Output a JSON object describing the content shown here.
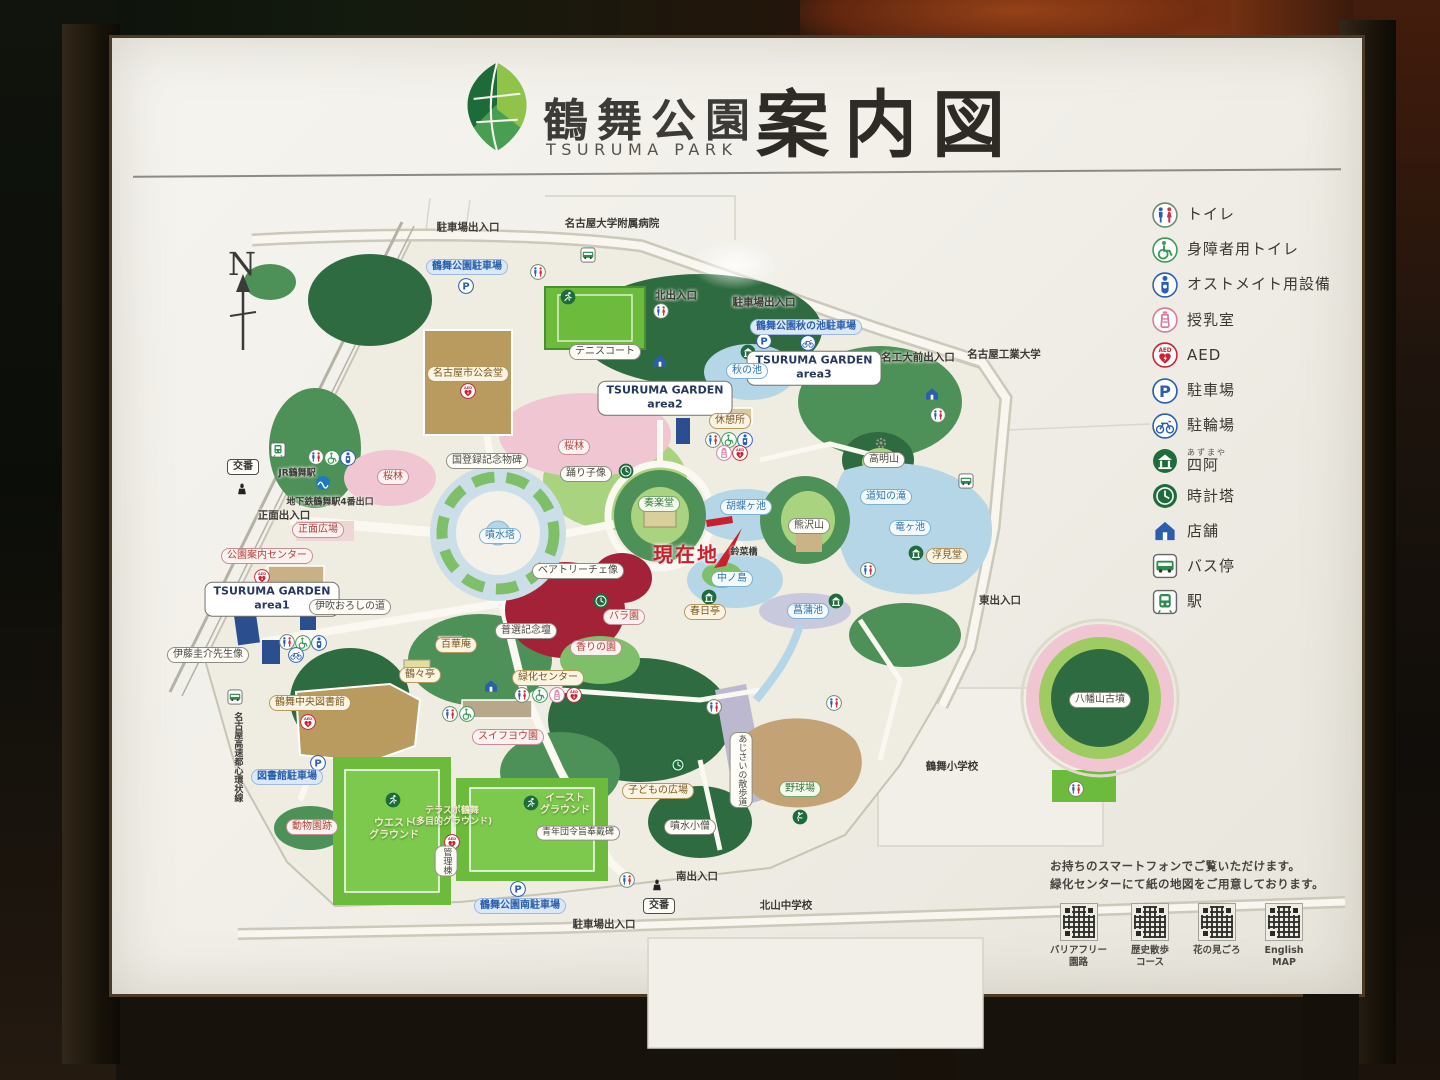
{
  "header": {
    "jp": "鶴舞公園",
    "en": "TSURUMA PARK",
    "main": "案内図"
  },
  "legend": {
    "items": [
      {
        "icon": "toilet",
        "label": "トイレ"
      },
      {
        "icon": "wheelchair",
        "label": "身障者用トイレ"
      },
      {
        "icon": "ostomate",
        "label": "オストメイト用設備"
      },
      {
        "icon": "nursing",
        "label": "授乳室"
      },
      {
        "icon": "aed",
        "label": "AED"
      },
      {
        "icon": "parking",
        "label": "駐車場"
      },
      {
        "icon": "bicycle",
        "label": "駐輪場"
      },
      {
        "icon": "azumaya",
        "label": "四阿",
        "ruby": "あずまや"
      },
      {
        "icon": "clock",
        "label": "時計塔"
      },
      {
        "icon": "shop",
        "label": "店舗"
      },
      {
        "icon": "bus",
        "label": "バス停"
      },
      {
        "icon": "station",
        "label": "駅"
      }
    ]
  },
  "map": {
    "north": "N",
    "current": {
      "t": "現在地",
      "x": 686,
      "y": 553
    },
    "labels": [
      {
        "t": "駐車場出入口",
        "x": 468,
        "y": 228,
        "s": "plain"
      },
      {
        "t": "名古屋大学附属病院",
        "x": 612,
        "y": 224,
        "s": "plain"
      },
      {
        "t": "北出入口",
        "x": 676,
        "y": 296,
        "s": "plain"
      },
      {
        "t": "駐車場出入口",
        "x": 764,
        "y": 303,
        "s": "plain"
      },
      {
        "t": "名工大前出入口",
        "x": 918,
        "y": 358,
        "s": "plain"
      },
      {
        "t": "名古屋工業大学",
        "x": 1004,
        "y": 355,
        "s": "plain"
      },
      {
        "t": "東出入口",
        "x": 1000,
        "y": 601,
        "s": "plain"
      },
      {
        "t": "南出入口",
        "x": 697,
        "y": 877,
        "s": "plain"
      },
      {
        "t": "駐車場出入口",
        "x": 604,
        "y": 925,
        "s": "plain"
      },
      {
        "t": "正面出入口",
        "x": 284,
        "y": 516,
        "s": "plain"
      },
      {
        "t": "地下鉄鶴舞駅4番出口",
        "x": 330,
        "y": 503,
        "s": "plain",
        "fs": 9
      },
      {
        "t": "JR鶴舞駅",
        "x": 297,
        "y": 474,
        "s": "plain",
        "fs": 9
      },
      {
        "t": "鶴舞小学校",
        "x": 952,
        "y": 767,
        "s": "plain"
      },
      {
        "t": "北山中学校",
        "x": 786,
        "y": 906,
        "s": "plain"
      },
      {
        "t": "名古屋高速都心環状線",
        "x": 237,
        "y": 757,
        "s": "plain",
        "v": true,
        "fs": 9
      },
      {
        "t": "交番",
        "x": 243,
        "y": 467,
        "s": "box"
      },
      {
        "t": "交番",
        "x": 659,
        "y": 906,
        "s": "box"
      },
      {
        "t": "テニスコート",
        "x": 605,
        "y": 352,
        "s": "white"
      },
      {
        "t": "鶴舞公園駐車場",
        "x": 467,
        "y": 267,
        "s": "parking"
      },
      {
        "t": "鶴舞公園秋の池駐車場",
        "x": 806,
        "y": 327,
        "s": "parking"
      },
      {
        "t": "図書館駐車場",
        "x": 287,
        "y": 777,
        "s": "parking"
      },
      {
        "t": "鶴舞公園南駐車場",
        "x": 520,
        "y": 906,
        "s": "parking"
      },
      {
        "t": "TSURUMA GARDEN\narea1",
        "x": 272,
        "y": 599,
        "s": "garden"
      },
      {
        "t": "TSURUMA GARDEN\narea2",
        "x": 665,
        "y": 398,
        "s": "garden"
      },
      {
        "t": "TSURUMA GARDEN\narea3",
        "x": 814,
        "y": 368,
        "s": "garden"
      },
      {
        "t": "名古屋市公会堂",
        "x": 468,
        "y": 374,
        "s": "park"
      },
      {
        "t": "休憩所",
        "x": 730,
        "y": 421,
        "s": "park"
      },
      {
        "t": "秋の池",
        "x": 747,
        "y": 371,
        "s": "water"
      },
      {
        "t": "桜林",
        "x": 574,
        "y": 447,
        "s": "red"
      },
      {
        "t": "桜林",
        "x": 393,
        "y": 477,
        "s": "red"
      },
      {
        "t": "国登録記念物碑",
        "x": 487,
        "y": 461,
        "s": "white"
      },
      {
        "t": "踊り子像",
        "x": 586,
        "y": 474,
        "s": "white"
      },
      {
        "t": "奏楽堂",
        "x": 659,
        "y": 504,
        "s": "green"
      },
      {
        "t": "噴水塔",
        "x": 500,
        "y": 536,
        "s": "water"
      },
      {
        "t": "胡蝶ヶ池",
        "x": 746,
        "y": 507,
        "s": "water"
      },
      {
        "t": "熊沢山",
        "x": 809,
        "y": 526,
        "s": "white"
      },
      {
        "t": "高明山",
        "x": 884,
        "y": 460,
        "s": "white"
      },
      {
        "t": "道知の滝",
        "x": 886,
        "y": 497,
        "s": "water"
      },
      {
        "t": "竜ヶ池",
        "x": 910,
        "y": 528,
        "s": "water"
      },
      {
        "t": "浮見堂",
        "x": 947,
        "y": 556,
        "s": "park"
      },
      {
        "t": "鈴菜橋",
        "x": 744,
        "y": 553,
        "s": "plain",
        "fs": 9
      },
      {
        "t": "中ノ島",
        "x": 732,
        "y": 579,
        "s": "water"
      },
      {
        "t": "春日亭",
        "x": 705,
        "y": 612,
        "s": "park"
      },
      {
        "t": "菖蒲池",
        "x": 808,
        "y": 611,
        "s": "water"
      },
      {
        "t": "ベアトリーチェ像",
        "x": 578,
        "y": 571,
        "s": "white"
      },
      {
        "t": "バラ園",
        "x": 624,
        "y": 617,
        "s": "red"
      },
      {
        "t": "香りの園",
        "x": 596,
        "y": 648,
        "s": "red"
      },
      {
        "t": "普選記念壇",
        "x": 526,
        "y": 631,
        "s": "white"
      },
      {
        "t": "正面広場",
        "x": 318,
        "y": 530,
        "s": "red"
      },
      {
        "t": "公園案内センター",
        "x": 267,
        "y": 556,
        "s": "red"
      },
      {
        "t": "伊吹おろしの道",
        "x": 350,
        "y": 607,
        "s": "white"
      },
      {
        "t": "伊藤圭介先生像",
        "x": 208,
        "y": 655,
        "s": "white"
      },
      {
        "t": "鶴々亭",
        "x": 420,
        "y": 675,
        "s": "park"
      },
      {
        "t": "百華庵",
        "x": 456,
        "y": 645,
        "s": "park"
      },
      {
        "t": "緑化センター",
        "x": 548,
        "y": 678,
        "s": "park"
      },
      {
        "t": "スイフヨウ園",
        "x": 508,
        "y": 737,
        "s": "red"
      },
      {
        "t": "鶴舞中央図書館",
        "x": 310,
        "y": 703,
        "s": "park"
      },
      {
        "t": "動物園跡",
        "x": 312,
        "y": 827,
        "s": "red"
      },
      {
        "t": "テラスポ鶴舞\n(多目的グラウンド)",
        "x": 452,
        "y": 817,
        "s": "field",
        "fs": 9
      },
      {
        "t": "ウエスト\nグラウンド",
        "x": 394,
        "y": 830,
        "s": "field"
      },
      {
        "t": "イースト\nグラウンド",
        "x": 565,
        "y": 805,
        "s": "field"
      },
      {
        "t": "管理棟",
        "x": 446,
        "y": 861,
        "s": "white",
        "v": true,
        "fs": 9
      },
      {
        "t": "青年団令旨奉戴碑",
        "x": 578,
        "y": 833,
        "s": "white",
        "fs": 9
      },
      {
        "t": "子どもの広場",
        "x": 658,
        "y": 791,
        "s": "park"
      },
      {
        "t": "噴水小僧",
        "x": 690,
        "y": 827,
        "s": "white"
      },
      {
        "t": "あじさいの散歩道",
        "x": 741,
        "y": 770,
        "s": "white",
        "v": true,
        "fs": 9
      },
      {
        "t": "野球場",
        "x": 800,
        "y": 789,
        "s": "green"
      },
      {
        "t": "八幡山古墳",
        "x": 1100,
        "y": 700,
        "s": "white"
      }
    ],
    "icons": [
      {
        "k": "toilet",
        "x": 538,
        "y": 272
      },
      {
        "k": "toilet",
        "x": 661,
        "y": 311
      },
      {
        "k": "toilet",
        "x": 938,
        "y": 415
      },
      {
        "k": "toilet",
        "x": 713,
        "y": 440
      },
      {
        "k": "toilet",
        "x": 316,
        "y": 457
      },
      {
        "k": "toilet",
        "x": 287,
        "y": 642
      },
      {
        "k": "toilet",
        "x": 868,
        "y": 570
      },
      {
        "k": "toilet",
        "x": 714,
        "y": 707
      },
      {
        "k": "toilet",
        "x": 834,
        "y": 703
      },
      {
        "k": "toilet",
        "x": 627,
        "y": 880
      },
      {
        "k": "toilet",
        "x": 1076,
        "y": 789
      },
      {
        "k": "toilet",
        "x": 522,
        "y": 695
      },
      {
        "k": "toilet",
        "x": 450,
        "y": 714
      },
      {
        "k": "wheelchair",
        "x": 729,
        "y": 440
      },
      {
        "k": "wheelchair",
        "x": 332,
        "y": 458
      },
      {
        "k": "wheelchair",
        "x": 303,
        "y": 643
      },
      {
        "k": "wheelchair",
        "x": 540,
        "y": 695
      },
      {
        "k": "wheelchair",
        "x": 467,
        "y": 714
      },
      {
        "k": "ostomate",
        "x": 745,
        "y": 440
      },
      {
        "k": "ostomate",
        "x": 348,
        "y": 458
      },
      {
        "k": "ostomate",
        "x": 319,
        "y": 643
      },
      {
        "k": "nursing",
        "x": 724,
        "y": 453
      },
      {
        "k": "nursing",
        "x": 557,
        "y": 695
      },
      {
        "k": "aed",
        "x": 740,
        "y": 453
      },
      {
        "k": "aed",
        "x": 468,
        "y": 391
      },
      {
        "k": "aed",
        "x": 262,
        "y": 577
      },
      {
        "k": "aed",
        "x": 308,
        "y": 722
      },
      {
        "k": "aed",
        "x": 574,
        "y": 695
      },
      {
        "k": "aed",
        "x": 452,
        "y": 842
      },
      {
        "k": "parking",
        "x": 466,
        "y": 286
      },
      {
        "k": "parking",
        "x": 764,
        "y": 341
      },
      {
        "k": "parking",
        "x": 318,
        "y": 763
      },
      {
        "k": "parking",
        "x": 518,
        "y": 889
      },
      {
        "k": "bicycle",
        "x": 808,
        "y": 343
      },
      {
        "k": "bicycle",
        "x": 296,
        "y": 655
      },
      {
        "k": "bus",
        "x": 588,
        "y": 255
      },
      {
        "k": "bus",
        "x": 966,
        "y": 481
      },
      {
        "k": "bus",
        "x": 235,
        "y": 697
      },
      {
        "k": "azumaya",
        "x": 748,
        "y": 352
      },
      {
        "k": "azumaya",
        "x": 916,
        "y": 553
      },
      {
        "k": "azumaya",
        "x": 709,
        "y": 597
      },
      {
        "k": "azumaya",
        "x": 836,
        "y": 601
      },
      {
        "k": "clock",
        "x": 626,
        "y": 471
      },
      {
        "k": "clock",
        "x": 601,
        "y": 601
      },
      {
        "k": "clock",
        "x": 678,
        "y": 765
      },
      {
        "k": "shop",
        "x": 660,
        "y": 361
      },
      {
        "k": "shop",
        "x": 932,
        "y": 394
      },
      {
        "k": "shop",
        "x": 491,
        "y": 686
      },
      {
        "k": "train",
        "x": 278,
        "y": 450
      },
      {
        "k": "subway",
        "x": 323,
        "y": 483
      },
      {
        "k": "police",
        "x": 242,
        "y": 489
      },
      {
        "k": "police",
        "x": 657,
        "y": 885
      },
      {
        "k": "runner",
        "x": 568,
        "y": 297
      },
      {
        "k": "runner",
        "x": 531,
        "y": 803
      },
      {
        "k": "runner",
        "x": 393,
        "y": 800
      },
      {
        "k": "baseball",
        "x": 800,
        "y": 817
      },
      {
        "k": "gear",
        "x": 881,
        "y": 443
      }
    ]
  },
  "footer": {
    "line1": "お持ちのスマートフォンでご覧いただけます。",
    "line2": "緑化センターにて紙の地図をご用意しております。",
    "qr": [
      {
        "label": "バリアフリー\n園路"
      },
      {
        "label": "歴史散歩\nコース"
      },
      {
        "label": "花の見ごろ"
      },
      {
        "label": "English\nMAP"
      }
    ]
  },
  "colors": {
    "accent_red": "#c9202e",
    "park_green": "#2f6b40",
    "water_blue": "#b5d6e6"
  }
}
